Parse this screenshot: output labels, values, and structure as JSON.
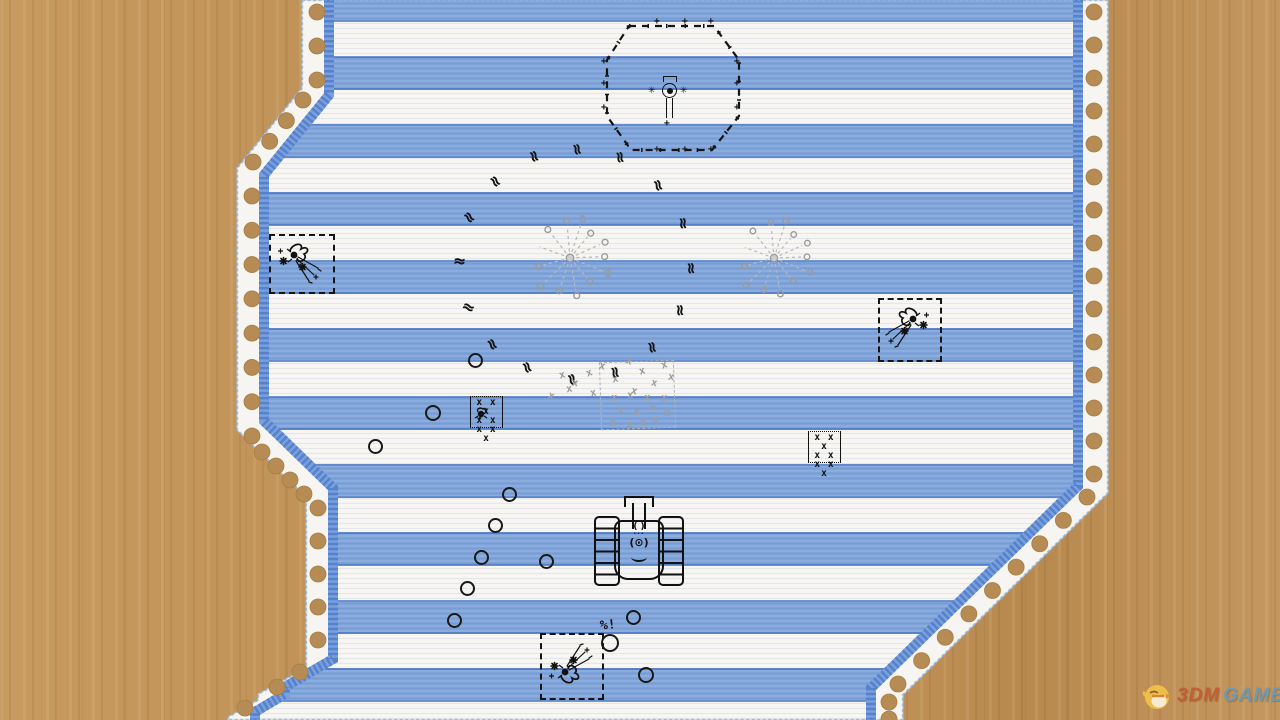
{
  "colors": {
    "wood": "#c19259",
    "paper": "#f6f5f1",
    "stripe_blue": "#7ea3d9",
    "stripe_edge": "#4f7cc9",
    "margin_band": "#7aa0dc",
    "margin_band_dark": "#5581cd",
    "hole_brown": "#b68b54",
    "ink": "#131313",
    "faded_gray": "#9d9d9d",
    "brand_3dm": "#c35b33",
    "brand_game": "#6b9ab5"
  },
  "glyphs": {
    "squiggle": "≈",
    "mine_x": "x",
    "plus": "+",
    "asterisk": "✳",
    "tank_body_top": "( )",
    "tank_dots": "···",
    "tank_core": "(⊙)"
  },
  "labels": {
    "damage": "%!"
  },
  "watermark": {
    "logo": "chick-logo",
    "brand_first": "3DM",
    "brand_second": "GAME"
  },
  "sprites": {
    "hex_outpost": {
      "x": 596,
      "y": 16,
      "w": 150,
      "h": 142,
      "plus_points": [
        [
          58,
          2
        ],
        [
          86,
          2
        ],
        [
          112,
          2
        ],
        [
          5,
          42
        ],
        [
          5,
          64
        ],
        [
          5,
          88
        ],
        [
          138,
          42
        ],
        [
          138,
          64
        ],
        [
          138,
          88
        ],
        [
          58,
          130
        ],
        [
          86,
          130
        ],
        [
          112,
          130
        ]
      ]
    },
    "squiggles": [
      {
        "x": 528,
        "y": 150,
        "r": 70
      },
      {
        "x": 571,
        "y": 143,
        "r": 75
      },
      {
        "x": 614,
        "y": 151,
        "r": 80
      },
      {
        "x": 489,
        "y": 175,
        "r": 55
      },
      {
        "x": 652,
        "y": 179,
        "r": 70
      },
      {
        "x": 463,
        "y": 211,
        "r": 50
      },
      {
        "x": 677,
        "y": 217,
        "r": 85
      },
      {
        "x": 453,
        "y": 255,
        "r": 5
      },
      {
        "x": 685,
        "y": 262,
        "r": 85
      },
      {
        "x": 462,
        "y": 301,
        "r": 25
      },
      {
        "x": 674,
        "y": 304,
        "r": 85
      },
      {
        "x": 486,
        "y": 338,
        "r": 60
      },
      {
        "x": 646,
        "y": 341,
        "r": 75
      },
      {
        "x": 521,
        "y": 361,
        "r": 65
      },
      {
        "x": 566,
        "y": 373,
        "r": 70
      },
      {
        "x": 609,
        "y": 366,
        "r": 78
      }
    ],
    "rings": [
      {
        "x": 468,
        "y": 353,
        "d": 11
      },
      {
        "x": 425,
        "y": 405,
        "d": 12
      },
      {
        "x": 368,
        "y": 439,
        "d": 11
      },
      {
        "x": 502,
        "y": 487,
        "d": 11
      },
      {
        "x": 488,
        "y": 518,
        "d": 11
      },
      {
        "x": 474,
        "y": 550,
        "d": 11
      },
      {
        "x": 539,
        "y": 554,
        "d": 11
      },
      {
        "x": 460,
        "y": 581,
        "d": 11
      },
      {
        "x": 447,
        "y": 613,
        "d": 11
      },
      {
        "x": 626,
        "y": 610,
        "d": 11
      },
      {
        "x": 601,
        "y": 634,
        "d": 14
      },
      {
        "x": 638,
        "y": 667,
        "d": 12
      }
    ],
    "explosions": [
      {
        "x": 269,
        "y": 234,
        "w": 62,
        "h": 56,
        "flip": "none"
      },
      {
        "x": 878,
        "y": 298,
        "w": 60,
        "h": 60,
        "flip": "x"
      },
      {
        "x": 540,
        "y": 633,
        "w": 60,
        "h": 63,
        "flip": "y"
      }
    ],
    "dandelions": [
      {
        "x": 570,
        "y": 258,
        "s": 1.05
      },
      {
        "x": 774,
        "y": 258,
        "s": 1.0
      }
    ],
    "mine_boxes": [
      {
        "x": 808,
        "y": 431,
        "w": 31,
        "h": 29,
        "rows": [
          "x x x",
          "x x",
          "x x x"
        ],
        "bug": false
      },
      {
        "x": 470,
        "y": 396,
        "w": 31,
        "h": 29,
        "rows": [
          "x x x",
          "x x",
          "x x x"
        ],
        "bug": true
      }
    ],
    "dead_minefield": {
      "x": 600,
      "y": 361,
      "w": 73,
      "h": 66,
      "rot": -2,
      "inner_xs": [
        [
          10,
          30
        ],
        [
          26,
          28
        ],
        [
          43,
          31
        ],
        [
          60,
          32
        ],
        [
          16,
          43
        ],
        [
          32,
          45
        ],
        [
          48,
          41
        ],
        [
          8,
          55
        ],
        [
          24,
          57
        ],
        [
          50,
          53
        ],
        [
          62,
          47
        ],
        [
          38,
          56
        ]
      ],
      "loose_xs": [
        [
          548,
          391,
          20
        ],
        [
          559,
          370,
          -15
        ],
        [
          572,
          378,
          10
        ],
        [
          586,
          368,
          -20
        ],
        [
          599,
          361,
          15
        ],
        [
          612,
          374,
          -10
        ],
        [
          626,
          356,
          20
        ],
        [
          639,
          366,
          -15
        ],
        [
          651,
          378,
          12
        ],
        [
          661,
          360,
          -18
        ],
        [
          668,
          372,
          8
        ],
        [
          590,
          388,
          -12
        ],
        [
          631,
          386,
          15
        ],
        [
          566,
          384,
          -8
        ]
      ]
    },
    "tank": {
      "x": 594,
      "y": 494,
      "w": 88,
      "h": 90
    },
    "damage_pos": {
      "x": 600,
      "y": 618
    }
  }
}
